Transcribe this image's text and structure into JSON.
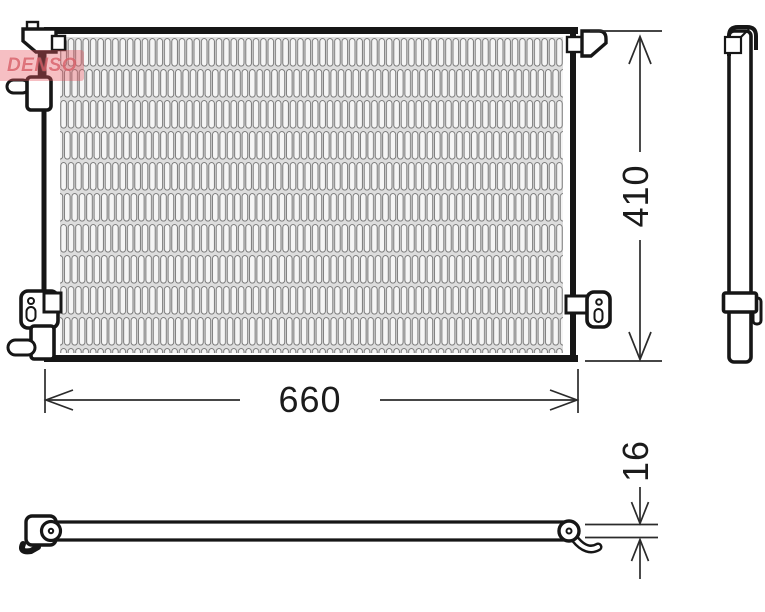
{
  "drawing": {
    "type": "technical-part-diagram",
    "part": "condenser",
    "dimension_labels": {
      "width": "660",
      "height": "410",
      "thickness": "16"
    }
  },
  "watermark": {
    "brand": "DENSO"
  },
  "colors": {
    "outline": "#161616",
    "dimension_line": "#2b2b2b",
    "core_fill": "#dddddd",
    "fin_stroke": "#6f6f6f",
    "fin_fill": "#f5f5f5",
    "watermark_red": "#e7606c"
  }
}
